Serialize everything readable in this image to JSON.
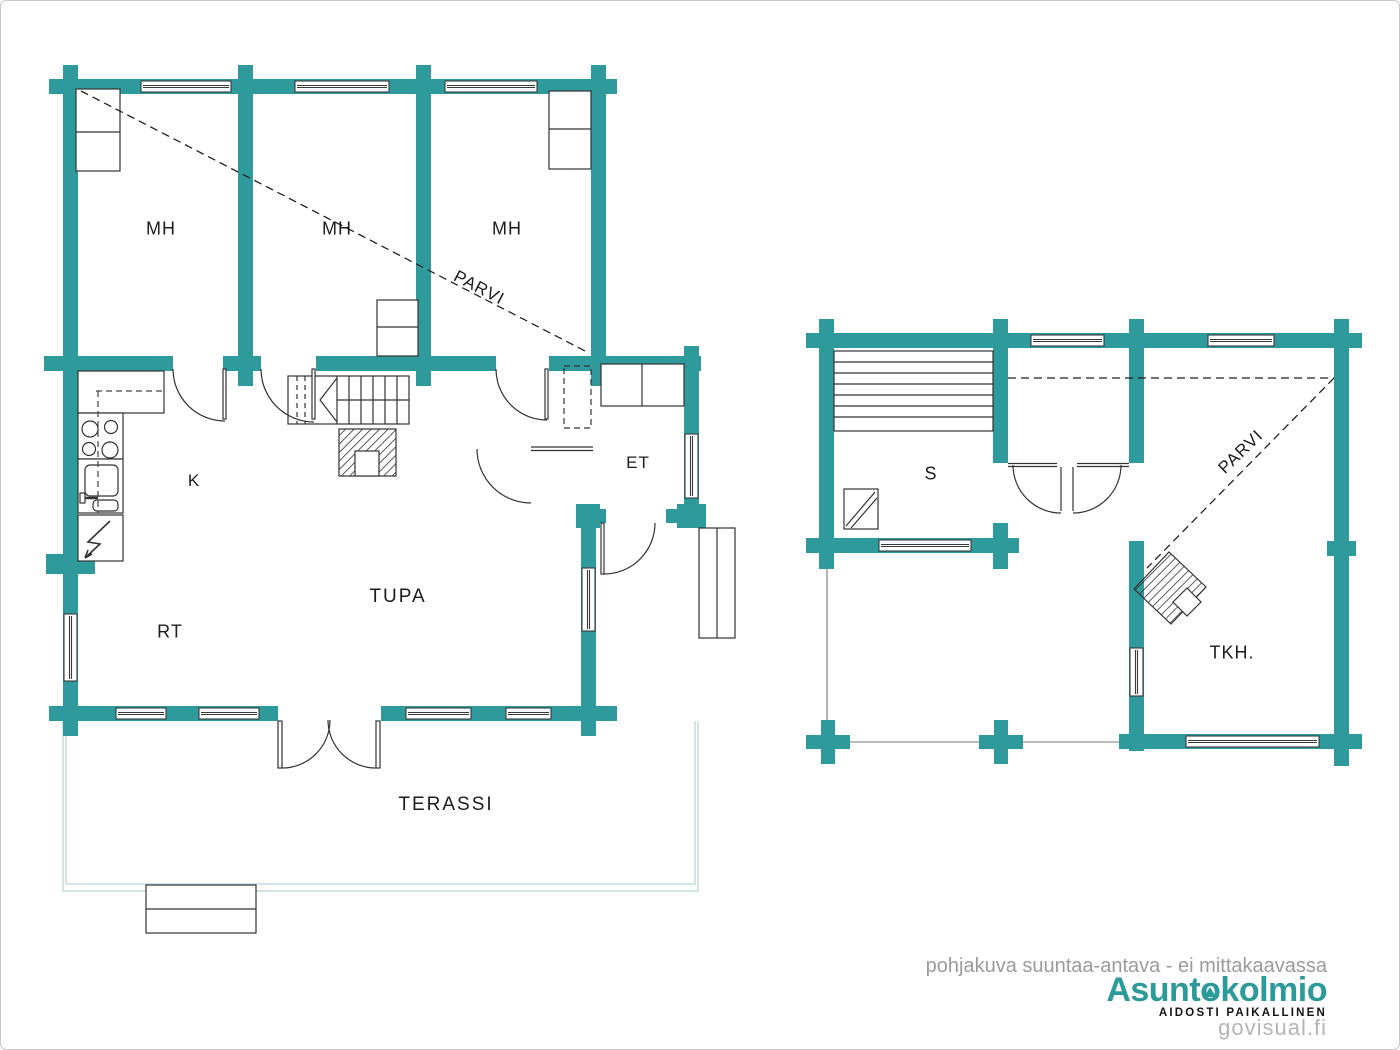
{
  "colors": {
    "wall_teal": "#2f9a9b",
    "line_dark": "#333333",
    "terrace_outline": "#b9d6d6",
    "logo_teal": "#2d9a9a",
    "footer_gray": "#9b9b9b",
    "watermark_gray": "#b5b5b5"
  },
  "floorplans": {
    "main_floor": {
      "bedroom_labels": [
        "MH",
        "MH",
        "MH"
      ],
      "loft_label": "PARVI",
      "kitchen_label": "K",
      "entry_label": "ET",
      "rt_label": "RT",
      "living_label": "TUPA",
      "terrace_label": "TERASSI"
    },
    "sauna_floor": {
      "sauna_label": "S",
      "loft_label": "PARVI",
      "tkh_label": "TKH."
    }
  },
  "footer": {
    "disclaimer": "pohjakuva suuntaa-antava - ei mittakaavassa",
    "brand_prefix": "Asunt",
    "brand_o": "o",
    "brand_suffix": "kolmio",
    "tagline": "AIDOSTI PAIKALLINEN",
    "watermark": "govisual.fi"
  }
}
